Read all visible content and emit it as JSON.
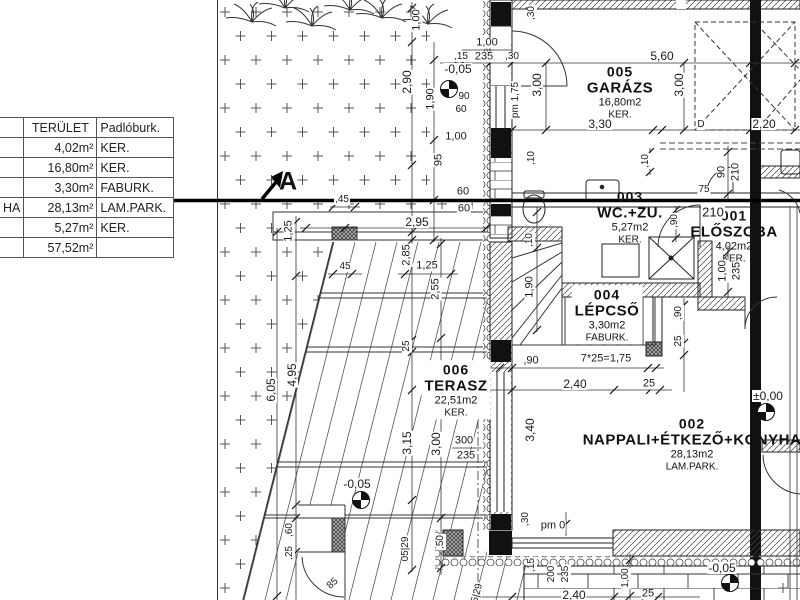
{
  "section_marker": "A",
  "table": {
    "headers": [
      "",
      "TERÜLET",
      "Padlóburk."
    ],
    "rows": [
      [
        "",
        "4,02m²",
        "KER."
      ],
      [
        "",
        "16,80m²",
        "KER."
      ],
      [
        "",
        "3,30m²",
        "FABURK."
      ],
      [
        "HA",
        "28,13m²",
        "LAM.PARK."
      ],
      [
        "",
        "5,27m²",
        "KER."
      ],
      [
        "",
        "57,52m²",
        ""
      ]
    ]
  },
  "rooms": [
    {
      "num": "005",
      "name": "GARÁZS",
      "area": "16,80m2",
      "floor": "KER.",
      "cx": 620,
      "cy": 92,
      "mask": false
    },
    {
      "num": "003",
      "name": "WC.+ZU.",
      "area": "5,27m2",
      "floor": "KER.",
      "cx": 630,
      "cy": 217,
      "mask": false
    },
    {
      "num": "001",
      "name": "ELŐSZOBA",
      "area": "4,02m2",
      "floor": "KER.",
      "cx": 734,
      "cy": 236,
      "mask": false
    },
    {
      "num": "004",
      "name": "LÉPCSŐ",
      "area": "3,30m2",
      "floor": "FABURK.",
      "cx": 607,
      "cy": 315,
      "mask": true
    },
    {
      "num": "006",
      "name": "TERASZ",
      "area": "22,51m2",
      "floor": "KER.",
      "cx": 456,
      "cy": 390,
      "mask": true
    },
    {
      "num": "002",
      "name": "NAPPALI+ÉTKEZŐ+KONYHA",
      "area": "28,13m2",
      "floor": "LAM.PARK.",
      "cx": 692,
      "cy": 444,
      "mask": false
    }
  ],
  "levels": [
    {
      "t": "-0,05",
      "x": 458,
      "y": 69,
      "sx": 449,
      "sy": 89
    },
    {
      "t": "-0,05",
      "x": 357,
      "y": 484,
      "sx": 361,
      "sy": 500
    },
    {
      "t": "±0,00",
      "x": 768,
      "y": 396,
      "sx": 766,
      "sy": 412
    },
    {
      "t": "-0,05",
      "x": 722,
      "y": 568,
      "sx": 730,
      "sy": 583
    }
  ],
  "dimensions": [
    {
      "t": "1,00",
      "x": 417,
      "y": 20,
      "r": -90
    },
    {
      "t": "2,90",
      "x": 407,
      "y": 82,
      "r": -90,
      "s": 12
    },
    {
      "t": "1,90",
      "x": 431,
      "y": 99,
      "r": -90
    },
    {
      "t": "95",
      "x": 439,
      "y": 160,
      "r": -90
    },
    {
      "t": "1,00",
      "x": 487,
      "y": 43
    },
    {
      "t": ",15",
      "x": 461,
      "y": 57,
      "s": 10
    },
    {
      "t": "235",
      "x": 484,
      "y": 57
    },
    {
      "t": ",30",
      "x": 512,
      "y": 57,
      "s": 10
    },
    {
      "t": "90",
      "x": 464,
      "y": 97,
      "s": 10
    },
    {
      "t": "60",
      "x": 461,
      "y": 110,
      "s": 10
    },
    {
      "t": "1,00",
      "x": 456,
      "y": 137
    },
    {
      "t": "60",
      "x": 463,
      "y": 192
    },
    {
      "t": "60",
      "x": 464,
      "y": 209
    },
    {
      "t": ",30",
      "x": 532,
      "y": 13,
      "r": -90,
      "s": 10
    },
    {
      "t": "pm 1,75",
      "x": 516,
      "y": 100,
      "r": -90,
      "s": 10
    },
    {
      "t": "3,00",
      "x": 537,
      "y": 85,
      "r": -90,
      "s": 12
    },
    {
      "t": "5,60",
      "x": 662,
      "y": 56,
      "s": 12
    },
    {
      "t": "3,00",
      "x": 679,
      "y": 85,
      "r": -90,
      "s": 12
    },
    {
      "t": "3,30",
      "x": 600,
      "y": 124,
      "s": 12
    },
    {
      "t": "2,20",
      "x": 764,
      "y": 124,
      "s": 12
    },
    {
      "t": "D",
      "x": 701,
      "y": 125,
      "s": 10
    },
    {
      "t": ",10",
      "x": 532,
      "y": 158,
      "r": -90,
      "s": 10
    },
    {
      "t": ",10",
      "x": 646,
      "y": 161,
      "r": -90,
      "s": 10
    },
    {
      "t": ",90",
      "x": 675,
      "y": 221,
      "r": -90,
      "s": 10
    },
    {
      "t": "75",
      "x": 704,
      "y": 190,
      "s": 10
    },
    {
      "t": "210",
      "x": 713,
      "y": 212,
      "s": 13
    },
    {
      "t": "90",
      "x": 722,
      "y": 172,
      "r": -90
    },
    {
      "t": "210",
      "x": 736,
      "y": 172,
      "r": -90
    },
    {
      "t": "1,00",
      "x": 723,
      "y": 271,
      "r": -90
    },
    {
      "t": "235",
      "x": 737,
      "y": 271,
      "r": -90
    },
    {
      "t": ",10",
      "x": 530,
      "y": 240,
      "r": -90,
      "s": 10
    },
    {
      "t": "1,90",
      "x": 530,
      "y": 287,
      "r": -90
    },
    {
      "t": ",90",
      "x": 531,
      "y": 361
    },
    {
      "t": "7*25=1,75",
      "x": 606,
      "y": 359
    },
    {
      "t": "2,40",
      "x": 575,
      "y": 384,
      "s": 12
    },
    {
      "t": "25",
      "x": 649,
      "y": 384
    },
    {
      "t": ",90",
      "x": 679,
      "y": 313,
      "r": -90,
      "s": 10
    },
    {
      "t": "25",
      "x": 679,
      "y": 341,
      "r": -90,
      "s": 10
    },
    {
      "t": ",45",
      "x": 342,
      "y": 200,
      "s": 10
    },
    {
      "t": "2,95",
      "x": 417,
      "y": 222,
      "s": 12
    },
    {
      "t": "1,25",
      "x": 289,
      "y": 231,
      "r": -90
    },
    {
      "t": "45",
      "x": 345,
      "y": 267,
      "s": 10
    },
    {
      "t": "1,25",
      "x": 427,
      "y": 266
    },
    {
      "t": "2,85",
      "x": 407,
      "y": 255,
      "r": -90
    },
    {
      "t": "2,55",
      "x": 436,
      "y": 289,
      "r": -90
    },
    {
      "t": "25",
      "x": 407,
      "y": 346,
      "r": -90,
      "s": 10
    },
    {
      "t": "4,95",
      "x": 292,
      "y": 375,
      "r": -90,
      "s": 12
    },
    {
      "t": "6,05",
      "x": 271,
      "y": 390,
      "r": -90,
      "s": 12
    },
    {
      "t": "3,15",
      "x": 407,
      "y": 443,
      "r": -90,
      "s": 12
    },
    {
      "t": "3,00",
      "x": 436,
      "y": 444,
      "r": -90,
      "s": 12
    },
    {
      "t": "300",
      "x": 464,
      "y": 441
    },
    {
      "t": "235",
      "x": 466,
      "y": 456
    },
    {
      "t": "3,40",
      "x": 530,
      "y": 430,
      "r": -90,
      "s": 12
    },
    {
      "t": ",60",
      "x": 290,
      "y": 530,
      "r": -90,
      "s": 10
    },
    {
      "t": ",25",
      "x": 290,
      "y": 553,
      "r": -90,
      "s": 10
    },
    {
      "t": "85",
      "x": 333,
      "y": 584,
      "r": -40,
      "s": 10
    },
    {
      "t": "05|29",
      "x": 406,
      "y": 549,
      "r": -90,
      "s": 10
    },
    {
      "t": ",50",
      "x": 441,
      "y": 542,
      "r": -90,
      "s": 10
    },
    {
      "t": "05|29",
      "x": 477,
      "y": 596,
      "r": -75,
      "s": 10
    },
    {
      "t": ",30",
      "x": 526,
      "y": 519,
      "r": -90,
      "s": 10
    },
    {
      "t": "pm 0",
      "x": 553,
      "y": 526
    },
    {
      "t": ",15",
      "x": 532,
      "y": 565,
      "r": -90,
      "s": 10
    },
    {
      "t": "200",
      "x": 552,
      "y": 574,
      "r": -90,
      "s": 10
    },
    {
      "t": "235",
      "x": 566,
      "y": 574,
      "r": -90,
      "s": 10
    },
    {
      "t": "2,40",
      "x": 574,
      "y": 595,
      "s": 12
    },
    {
      "t": "1,00",
      "x": 626,
      "y": 578,
      "r": -90,
      "s": 10
    },
    {
      "t": "25",
      "x": 648,
      "y": 594
    }
  ]
}
